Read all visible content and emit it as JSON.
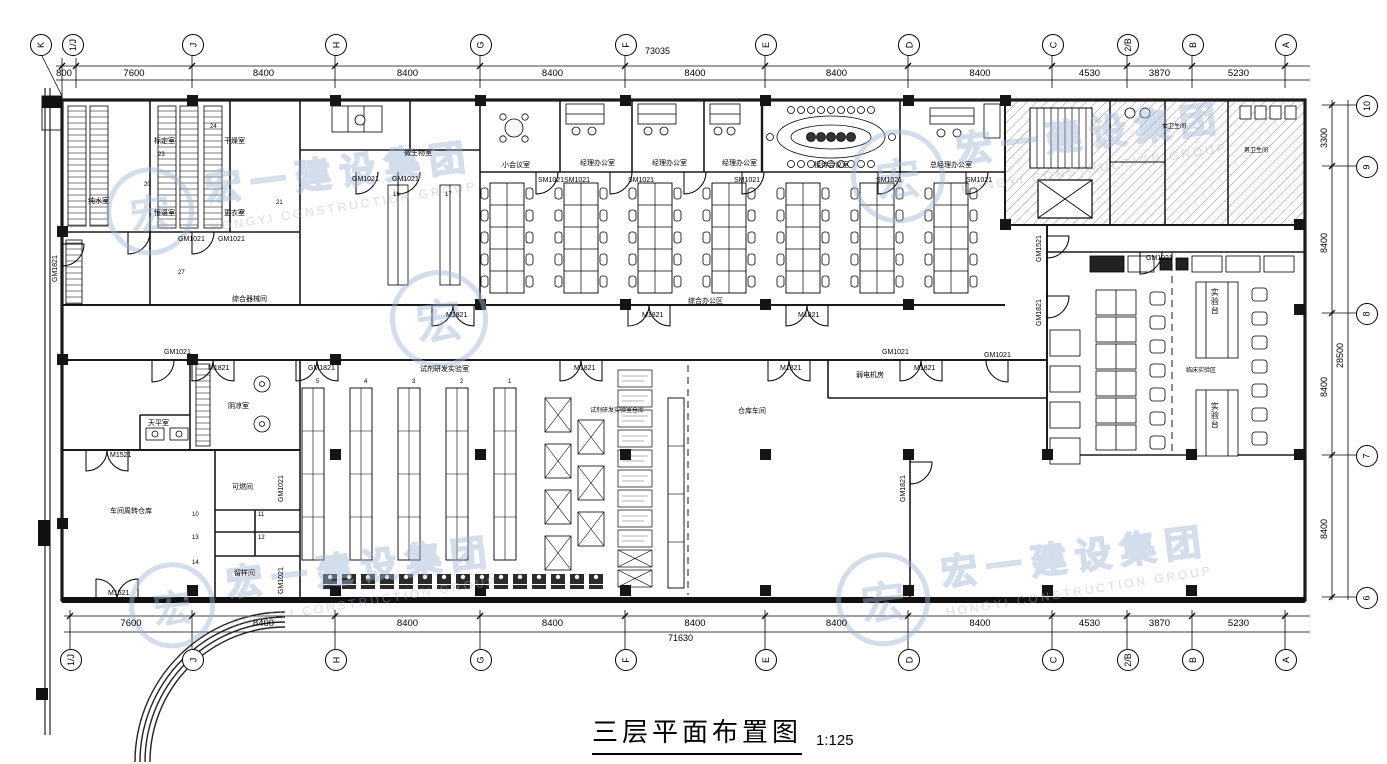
{
  "title": {
    "text": "三层平面布置图",
    "scale": "1:125"
  },
  "watermark": {
    "logo_char": "宏",
    "company_cn": "宏一建设集团",
    "company_en": "HONGYI CONSTRUCTION GROUP",
    "color": "#a0b4d4"
  },
  "axes": {
    "top": {
      "bubbles": [
        "K",
        "1/J",
        "J",
        "H",
        "G",
        "F",
        "E",
        "D",
        "C",
        "2/B",
        "B",
        "A"
      ],
      "dims": [
        "800",
        "7600",
        "8400",
        "8400",
        "8400",
        "8400",
        "8400",
        "8400",
        "4530",
        "3870",
        "5230"
      ],
      "overall": "73035"
    },
    "bottom": {
      "bubbles": [
        "1/J",
        "J",
        "H",
        "G",
        "F",
        "E",
        "D",
        "C",
        "2/B",
        "B",
        "A"
      ],
      "dims": [
        "7600",
        "8400",
        "8400",
        "8400",
        "8400",
        "8400",
        "8400",
        "4530",
        "3870",
        "5230"
      ],
      "overall": "71630"
    },
    "right": {
      "bubbles": [
        "10",
        "9",
        "8",
        "7",
        "6"
      ],
      "dims": [
        "3300",
        "8400",
        "8400",
        "8400"
      ],
      "overall": "28500"
    }
  },
  "doors": {
    "gm1021": "GM1021",
    "gm1821": "GM1821",
    "gm1521": "GM1521",
    "sm1021": "SM1021",
    "m1821": "M1821",
    "m1521": "M1521"
  },
  "rooms": {
    "chunshui": "纯水室",
    "biaoding": "标定室",
    "ganzao": "干燥室",
    "hengwen": "恒温室",
    "gengyi": "更衣室",
    "weishengwu": "微生物室",
    "qixie": "综合器械间",
    "xiaohuiyi": "小会议室",
    "jingli": "经理办公室",
    "jiedai": "接待会议室",
    "zongjingli": "总经理办公室",
    "zonghe": "综合办公区",
    "nvwc": "女卫生间",
    "nanwc": "男卫生间",
    "tianping": "天平室",
    "yinliang": "阴凉室",
    "keran": "可燃间",
    "liuyang": "留样间",
    "chejian": "车间周转仓库",
    "shiji": "试剂研发实验室",
    "shijicang": "试剂研发实验室仓库",
    "cangku": "仓库车间",
    "ruodian": "弱电机房",
    "linchuang": "临床实验区",
    "shiyantai": "实验台"
  },
  "tags": {
    "racks": [
      "5",
      "4",
      "3",
      "2",
      "1"
    ],
    "benches": [
      "16",
      "17"
    ],
    "cells": [
      "10",
      "11",
      "13",
      "12",
      "14"
    ],
    "upper": [
      "24",
      "23",
      "20",
      "21",
      "22",
      "27"
    ]
  }
}
